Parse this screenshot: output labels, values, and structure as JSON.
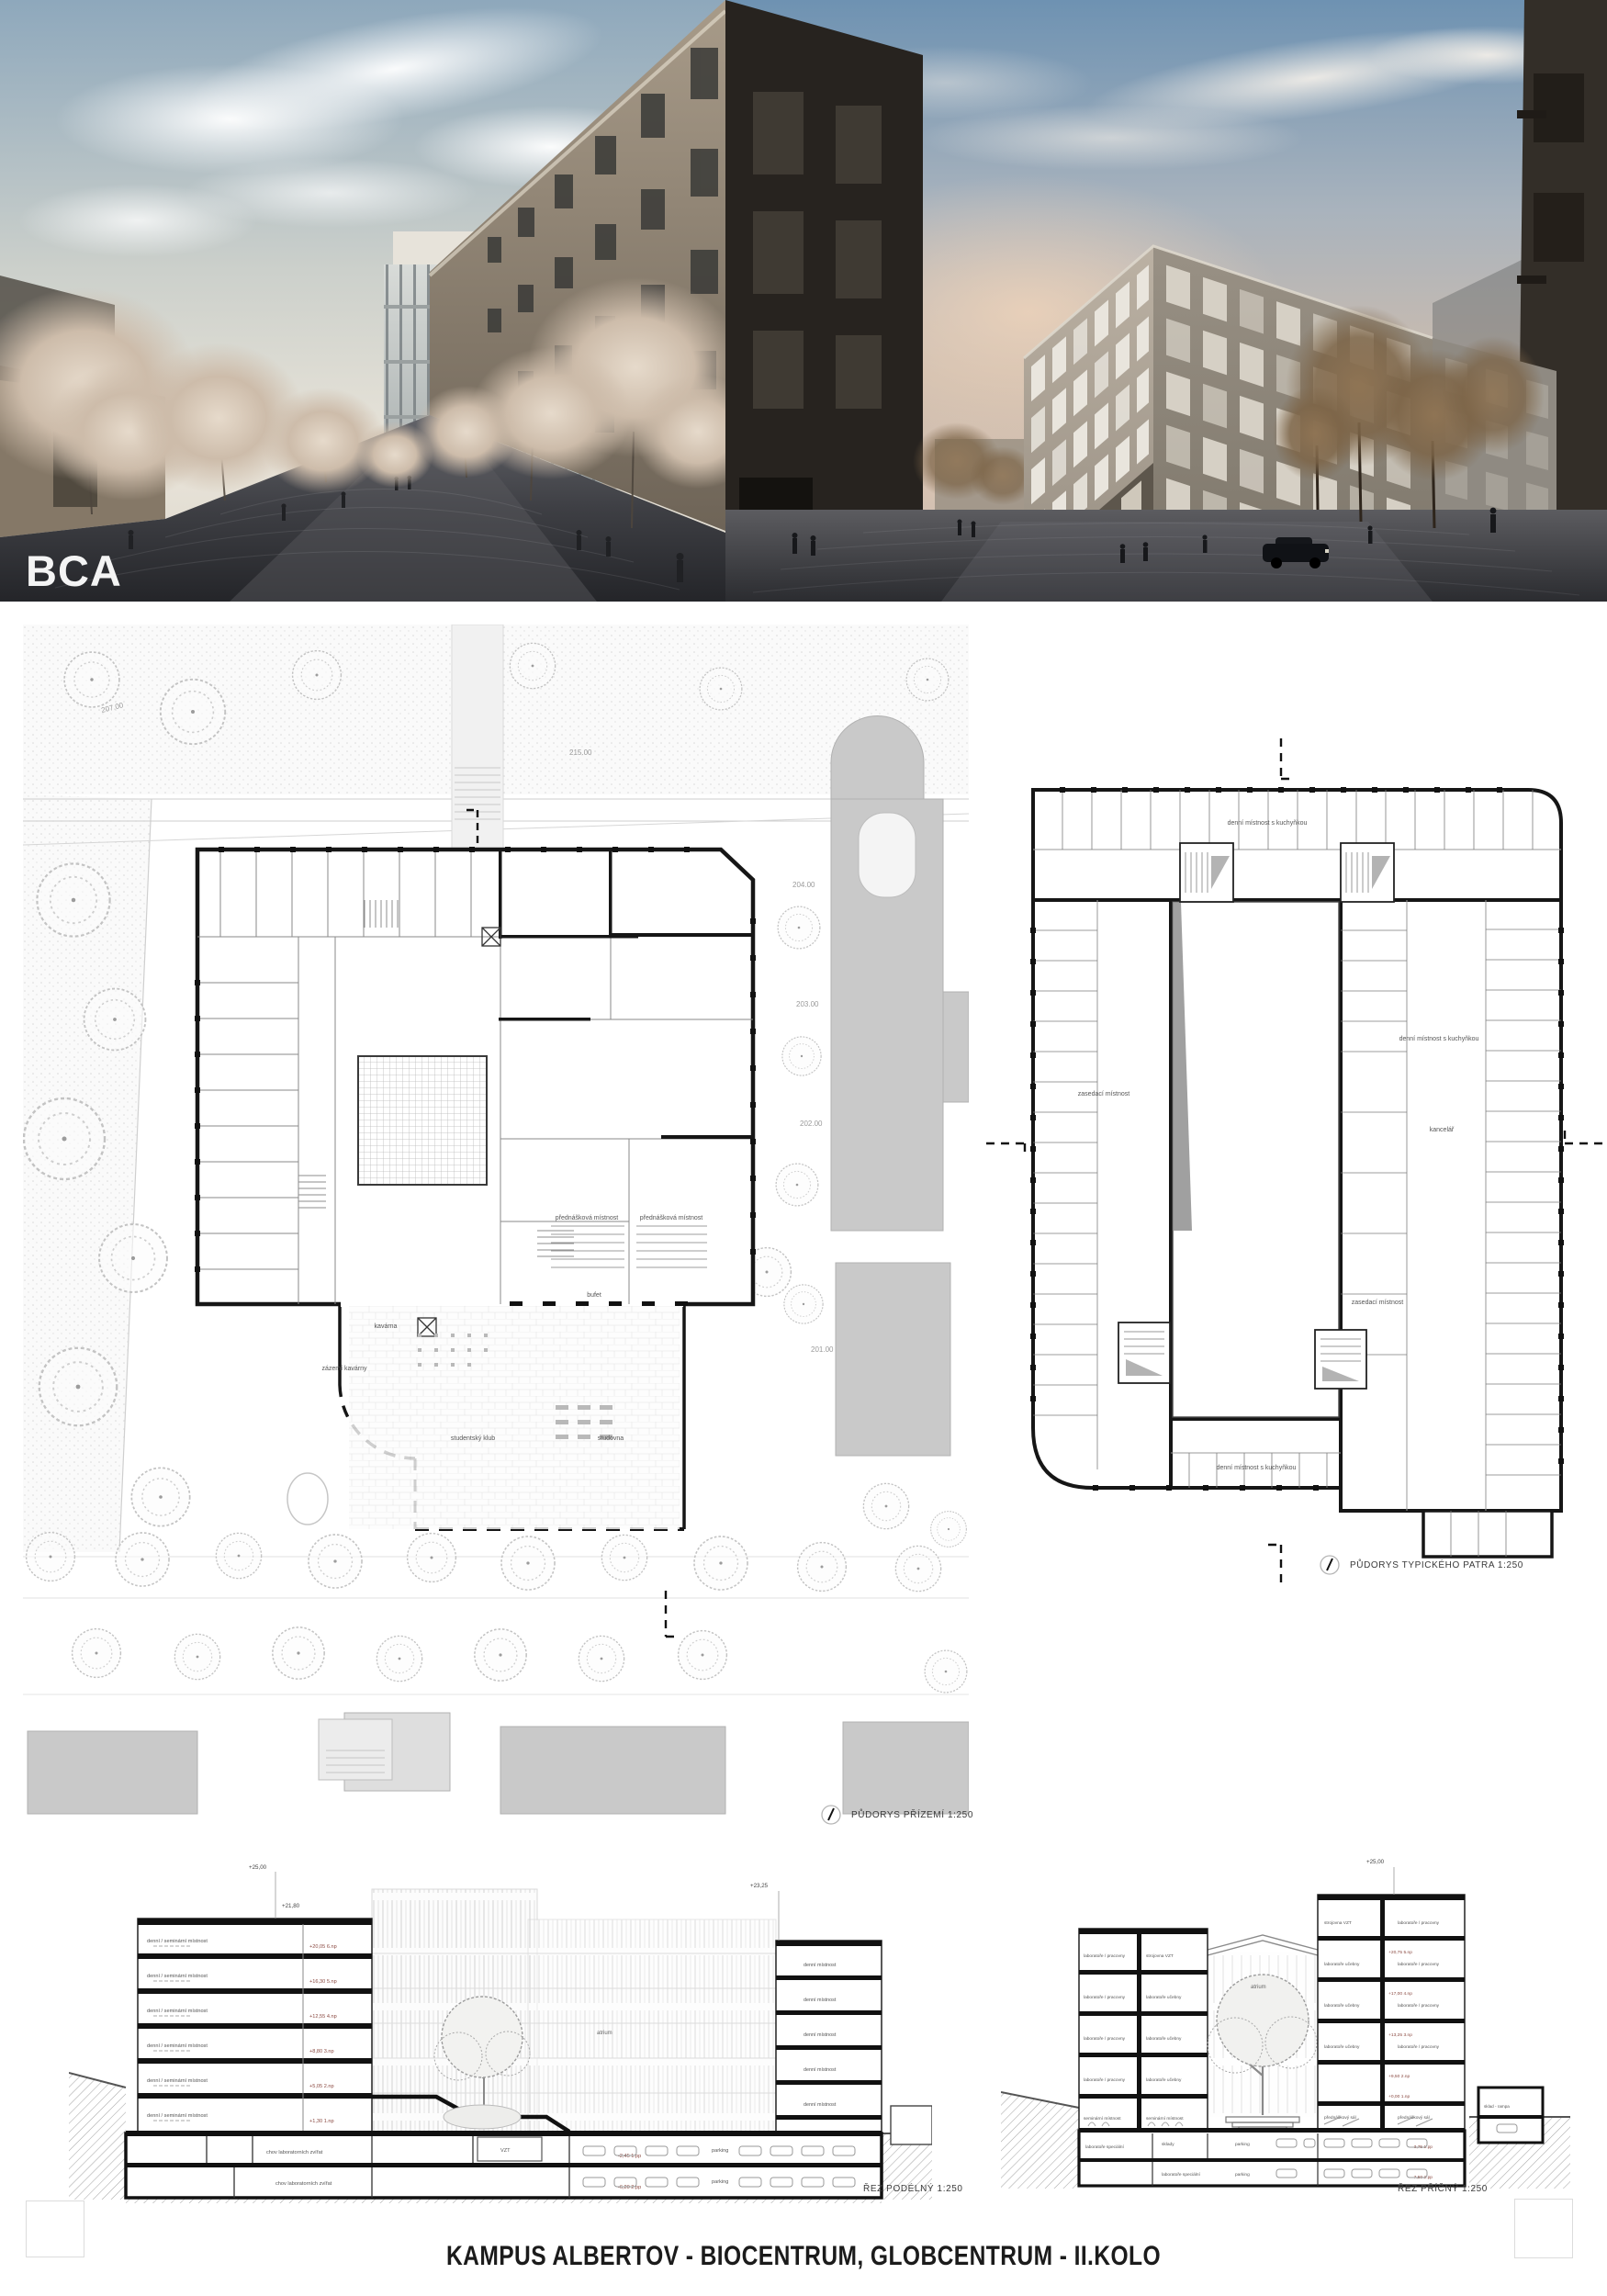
{
  "board": {
    "title": "KAMPUS ALBERTOV - BIOCENTRUM, GLOBCENTRUM - II.KOLO",
    "team_mark": "BCA"
  },
  "ground_plan": {
    "caption": "PŮDORYS PŘÍZEMÍ 1:250",
    "contours": [
      "207.00",
      "215.00",
      "204.00",
      "203.00",
      "202.00",
      "201.00"
    ],
    "rooms": {
      "lecture": "přednášková místnost",
      "cafe": "kavárna",
      "cafe_back": "zázemí kavárny",
      "club": "studentský klub",
      "study": "studovna",
      "buffet": "bufet"
    }
  },
  "typical_plan": {
    "caption": "PŮDORYS TYPICKÉHO PATRA 1:250",
    "rooms": {
      "day_room": "denní místnost s kuchyňkou",
      "meeting": "zasedací místnost",
      "office": "kancelář"
    }
  },
  "long_section": {
    "caption": "ŘEZ PODÉLNÝ 1:250",
    "top_levels": [
      "+25,00",
      "+21,80",
      "+23,25"
    ],
    "floor_levels": [
      "+20,05  6.np",
      "+16,30  5.np",
      "+12,55  4.np",
      "+8,80  3.np",
      "+5,05  2.np",
      "+1,30  1.np"
    ],
    "basement_levels": [
      "-2,45  1.pp",
      "-6,20  2.pp"
    ],
    "rooms": {
      "day_seminar": "denní / seminární místnost",
      "day": "denní místnost",
      "atrium": "atrium",
      "animals": "chov laboratorních zvířat",
      "vzt": "VZT",
      "parking": "parking"
    }
  },
  "cross_section": {
    "caption": "ŘEZ PŘÍČNÝ 1:250",
    "top_level": "+25,00",
    "floor_levels": [
      "+20,75  5.np",
      "+17,00  4.np",
      "+13,25  3.np",
      "+9,50  2.np",
      "+0,00  1.np"
    ],
    "basement_levels": [
      "-3,75  1.pp",
      "-7,50  2.pp"
    ],
    "rooms": {
      "labs_offices": "laboratoře / pracovny",
      "labs_teaching": "laboratoře učebny",
      "vzt_plant": "strojovna VZT",
      "seminar": "seminární místnost",
      "lecture_hall": "přednáškový sál",
      "storage": "sklady",
      "parking": "parking",
      "labs_special": "laboratoře speciální",
      "ramp": "sklad - rampa",
      "atrium": "atrium"
    }
  }
}
